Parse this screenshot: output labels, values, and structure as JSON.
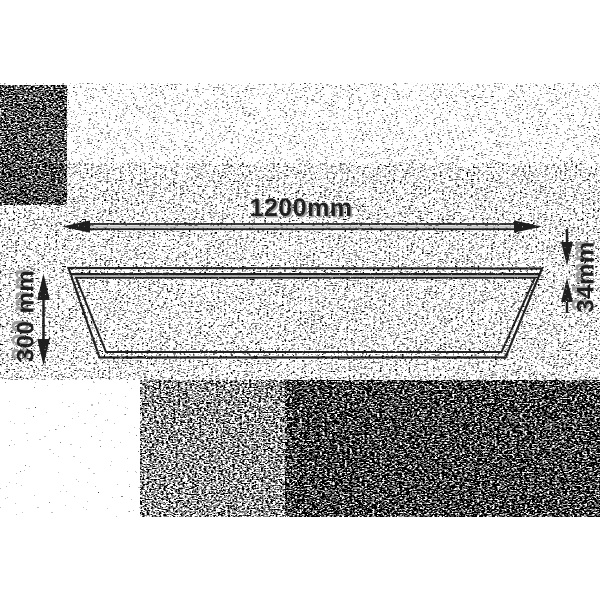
{
  "diagram": {
    "kind": "panel-dimension-drawing",
    "labels": {
      "width": "1200mm",
      "height": "300 mm",
      "thickness": "34mm"
    },
    "colors": {
      "background": "#ffffff",
      "line": "#1e1e1e",
      "emboss_highlight": "#c4c4c4",
      "noise": "#000000"
    }
  }
}
